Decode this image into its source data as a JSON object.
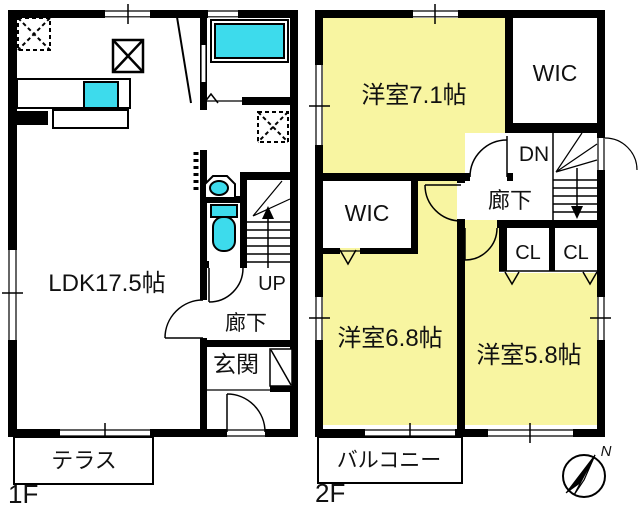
{
  "f1": {
    "floor": "1F",
    "ldk": "LDK17.5帖",
    "hallway": "廊下",
    "entrance": "玄関",
    "up": "UP",
    "terrace": "テラス"
  },
  "f2": {
    "floor": "2F",
    "bedroom71": "洋室7.1帖",
    "wic_top": "WIC",
    "wic_left": "WIC",
    "dn": "DN",
    "hallway": "廊下",
    "cl_left": "CL",
    "cl_right": "CL",
    "bedroom68": "洋室6.8帖",
    "bedroom58": "洋室5.8帖",
    "balcony": "バルコニー"
  },
  "compass": {
    "north": "N"
  },
  "colors": {
    "room_fill": "#f8f5a1",
    "water_fill": "#3ddbec",
    "wall": "#000000",
    "background": "#ffffff"
  }
}
